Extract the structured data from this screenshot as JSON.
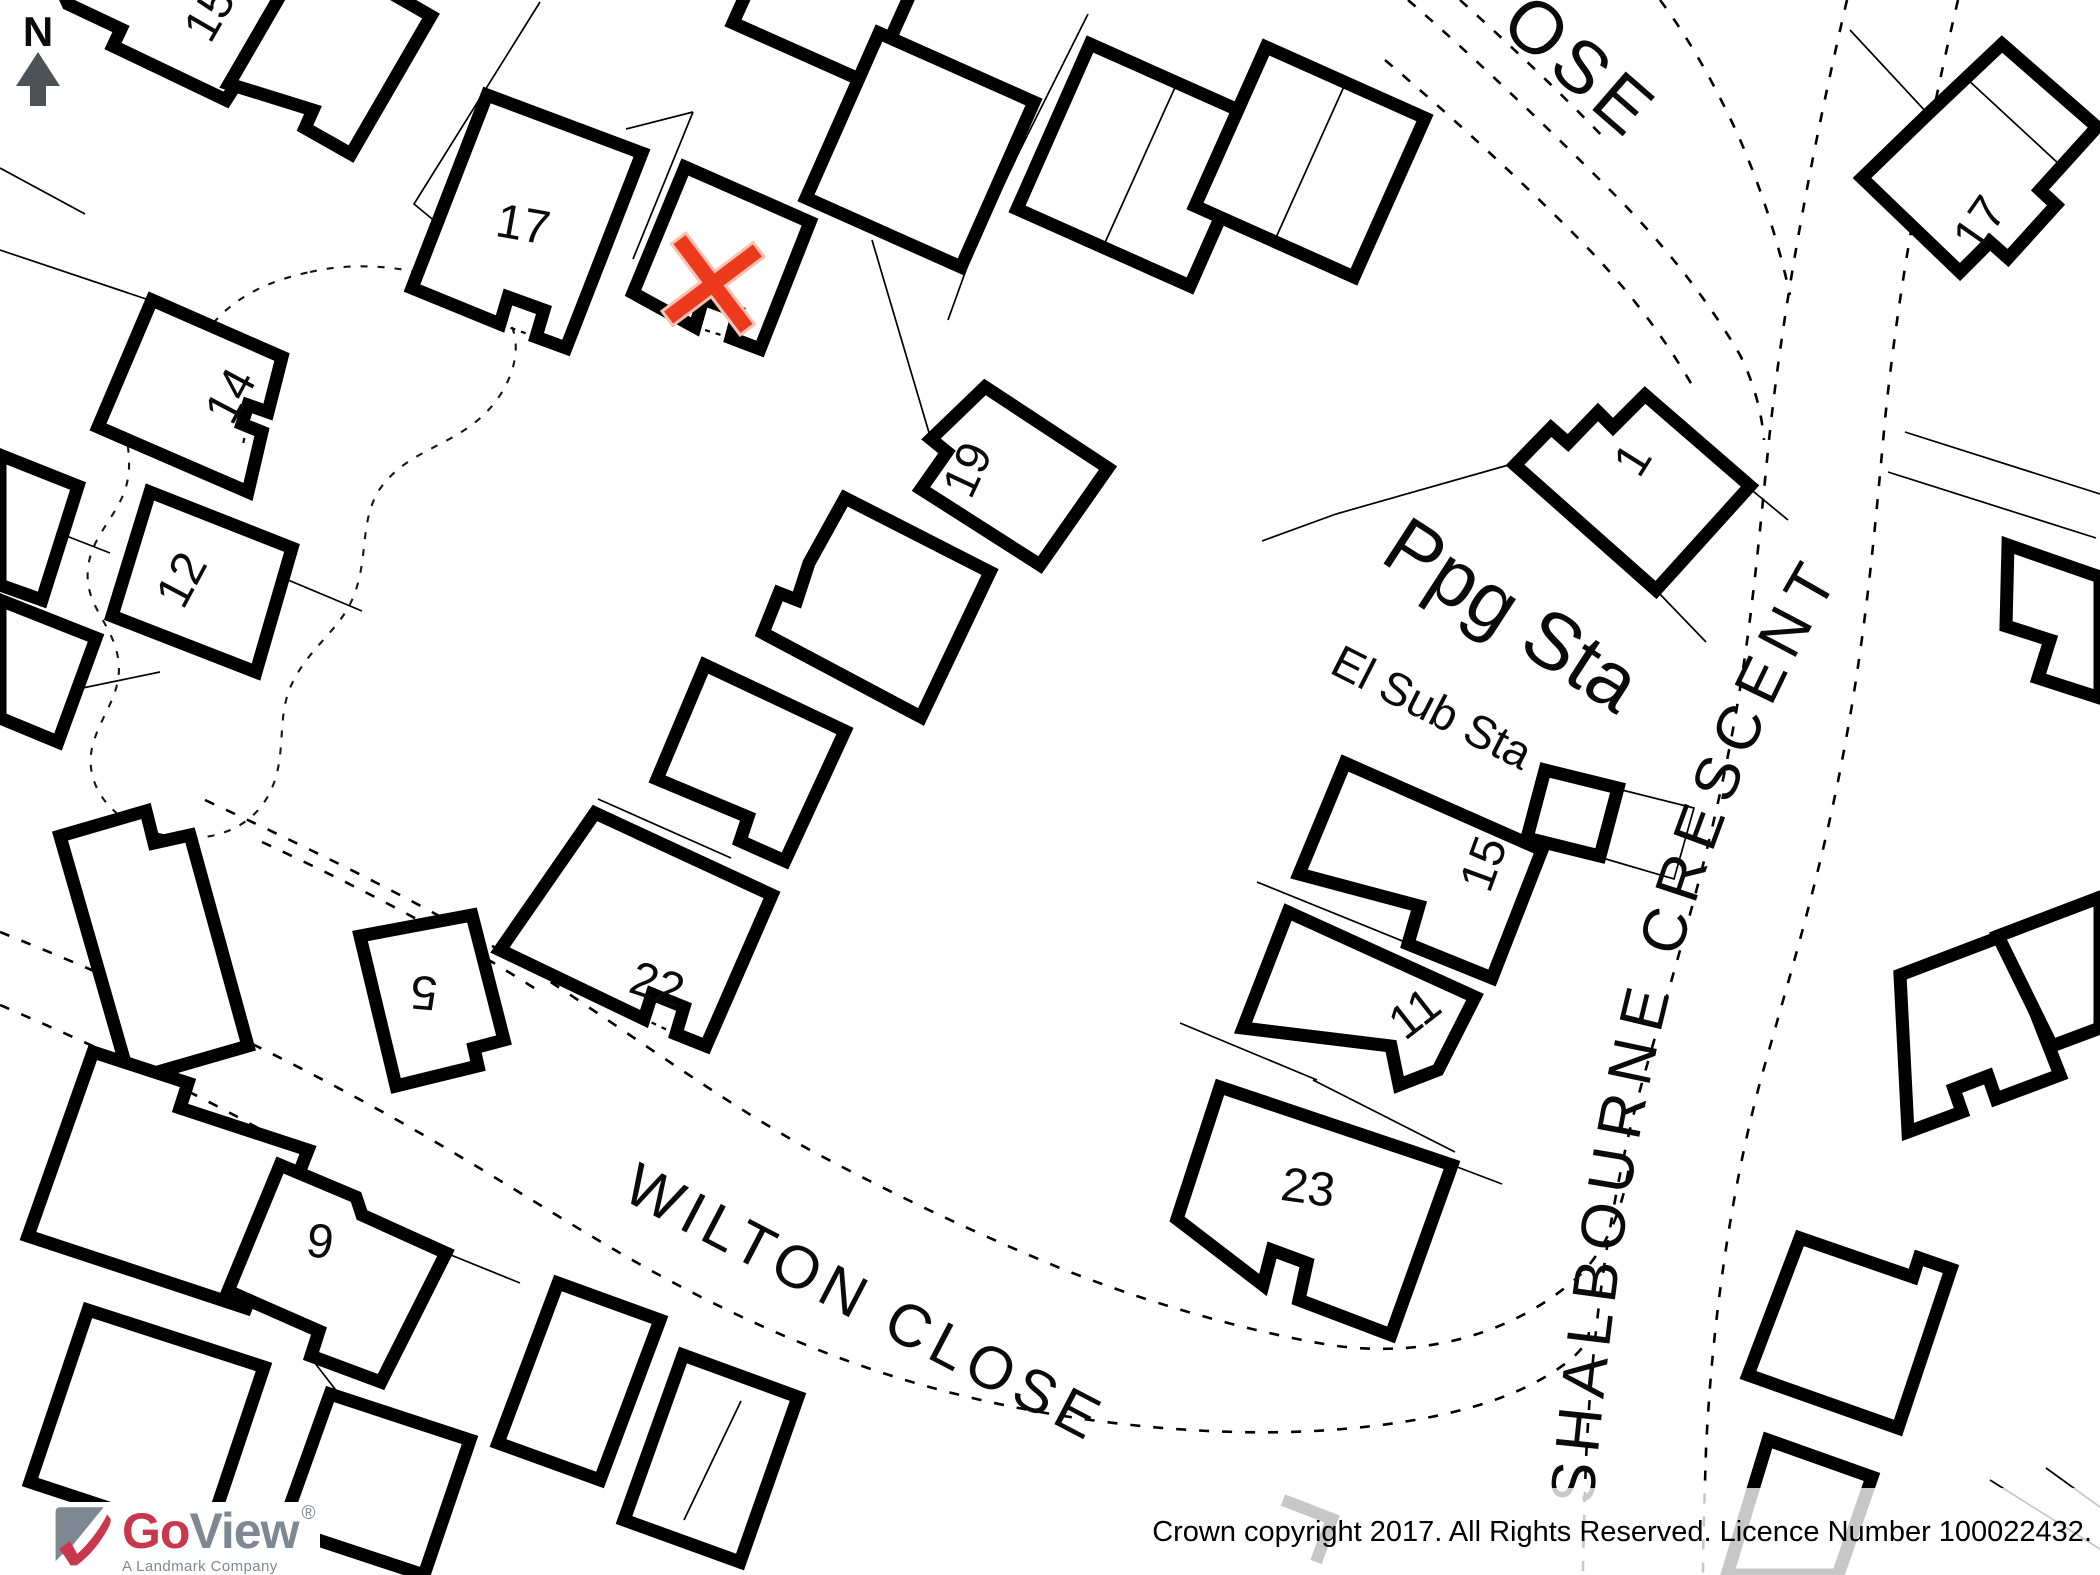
{
  "map": {
    "north_label": "N",
    "north_color": "#4d5257",
    "streets": {
      "wilton": "WILTON CLOSE",
      "shalbourne": "SHALBOURNE CRESCENT",
      "top_right_partial": "OSE"
    },
    "features": {
      "pumping_station": "Ppg Sta",
      "electric_substation": "El Sub Sta"
    },
    "building_numbers": [
      {
        "text": "15"
      },
      {
        "text": "17"
      },
      {
        "text": "14"
      },
      {
        "text": "12"
      },
      {
        "text": "19"
      },
      {
        "text": "22"
      },
      {
        "text": "9"
      },
      {
        "text": "5"
      },
      {
        "text": "23"
      },
      {
        "text": "11"
      },
      {
        "text": "15"
      },
      {
        "text": "1"
      },
      {
        "text": "17"
      }
    ],
    "marker": {
      "symbol": "X",
      "color": "#ee3a1c",
      "halo_color": "#f8c3b2"
    }
  },
  "branding": {
    "logo_go": "Go",
    "logo_view": "View",
    "logo_reg": "®",
    "logo_tagline": "A Landmark Company",
    "logo_red": "#c8374b",
    "logo_gray": "#7d8892"
  },
  "footer": {
    "copyright": "Crown copyright 2017. All Rights Reserved. Licence Number 100022432."
  }
}
